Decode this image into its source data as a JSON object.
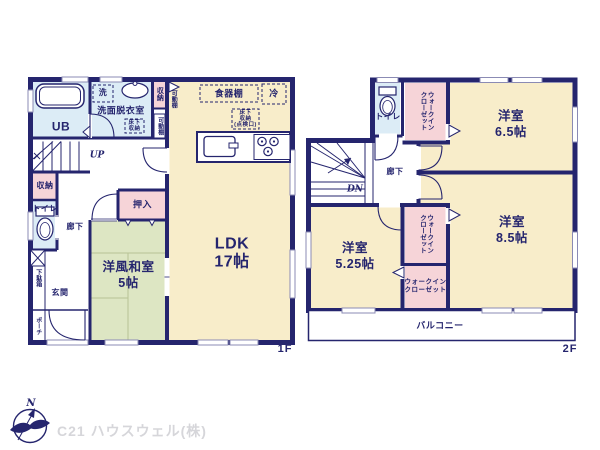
{
  "floor1": {
    "floor_label": "1F",
    "ub": "UB",
    "laundry": "洗",
    "washroom": "洗面脱衣室",
    "underfloor_storage": "床下\n収納",
    "storage_top": "収納",
    "movable_shelf_1": "可動棚",
    "movable_shelf_2": "可動棚",
    "cupboard": "食器棚",
    "fridge": "冷",
    "underfloor_inspection": "床下\n収納\n(点検口)",
    "ldk": "LDK\n17帖",
    "up": "UP",
    "storage_mid": "収納",
    "toilet": "トイレ",
    "hallway": "廊下",
    "oshiire": "押入",
    "washitsu": "洋風和室\n5帖",
    "shoe_cabinet": "下駄箱",
    "entrance": "玄関",
    "porch": "ポーチ"
  },
  "floor2": {
    "floor_label": "2F",
    "toilet": "トイレ",
    "wic_top": "ウォークイン\nクローゼット",
    "room_65": "洋室\n6.5帖",
    "hallway": "廊下",
    "dn": "DN",
    "room_525": "洋室\n5.25帖",
    "wic_mid": "ウォークイン\nクローゼット",
    "wic_low": "ウォークイン\nクローゼット",
    "room_85": "洋室\n8.5帖",
    "balcony": "バルコニー"
  },
  "footer": {
    "compass_n": "N",
    "company": "C21 ハウスウェル(株)"
  },
  "colors": {
    "wall_navy": "#25256e",
    "room_cream": "#f8edca",
    "room_green": "#dde6c3",
    "room_pink": "#f6d4d8",
    "room_blue": "#dcecf6",
    "tatami_line": "#b8c396",
    "company_gray": "#d6d6da"
  }
}
